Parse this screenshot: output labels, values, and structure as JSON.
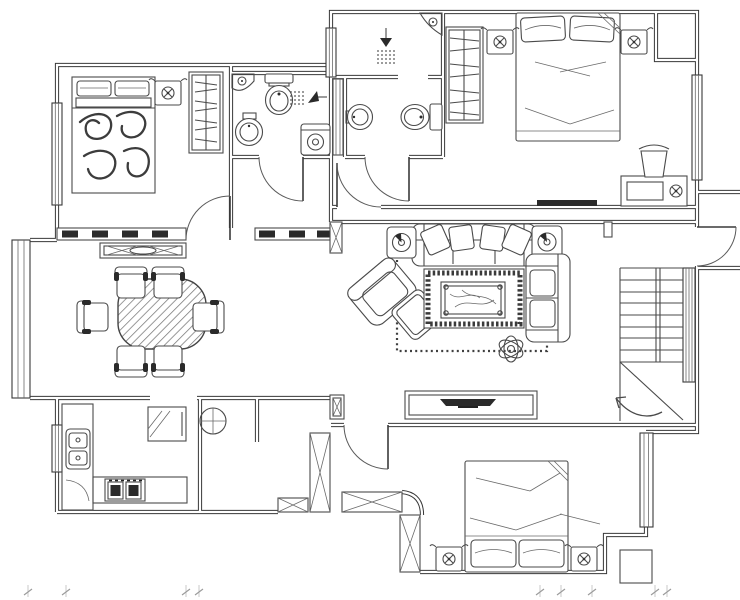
{
  "plan": {
    "type": "residential-apartment-floor-plan",
    "style": "black-and-white CAD line drawing, no text labels",
    "colors": {
      "background": "#ffffff",
      "walls": "#383838",
      "furniture": "#4a4a4a",
      "dark_fill": "#2a2a2a",
      "hatch": "#7a7a7a",
      "dimension_ticks": "#b5b5b5"
    },
    "rooms": [
      {
        "id": "bedroom-upper-left",
        "symbols": [
          "double-bed",
          "two-pillows",
          "patterned-blanket",
          "nightstand-with-lamp",
          "wardrobe-with-hangers",
          "window",
          "swing-door"
        ]
      },
      {
        "id": "bathroom-left",
        "symbols": [
          "toilet",
          "corner-shelf",
          "shower-head",
          "round-washbasin",
          "washing-machine",
          "swing-door"
        ]
      },
      {
        "id": "shower-room-center",
        "symbols": [
          "shower-head",
          "corner-washbasin",
          "window",
          "pipe-shaft"
        ]
      },
      {
        "id": "bathroom-center",
        "symbols": [
          "round-washbasin",
          "toilet",
          "swing-door"
        ]
      },
      {
        "id": "bedroom-upper-right",
        "symbols": [
          "double-bed",
          "two-pillows",
          "nightstand-with-lamp",
          "nightstand-with-lamp",
          "wardrobe-with-hangers",
          "corner-closet",
          "desk",
          "desk-chair",
          "desk-lamp",
          "wall-tv",
          "window",
          "outward-entry-door"
        ]
      },
      {
        "id": "dining-room",
        "symbols": [
          "oval-dining-table-hatched",
          "dining-chair-x6",
          "sideboard",
          "bay-window",
          "hatched-bearing-wall"
        ]
      },
      {
        "id": "living-room",
        "symbols": [
          "three-seat-sofa",
          "angled-cushions",
          "side-table-speaker",
          "side-table-speaker",
          "armchair",
          "ottoman",
          "marble-coffee-table",
          "ornate-rug",
          "chaise-sofa",
          "potted-plant",
          "tv-cabinet",
          "tv",
          "dotted-carpet-outline",
          "column"
        ]
      },
      {
        "id": "kitchen",
        "symbols": [
          "l-shaped-counter",
          "double-bowl-sink",
          "two-burner-stove",
          "refrigerator",
          "window",
          "floor-drain-circle"
        ]
      },
      {
        "id": "staircase",
        "symbols": [
          "steps",
          "handrail",
          "break-line",
          "direction-arrow",
          "glazed-partition"
        ]
      },
      {
        "id": "bedroom-lower-right",
        "symbols": [
          "double-bed",
          "two-pillows",
          "nightstand-with-lamp",
          "nightstand-with-lamp",
          "window",
          "swing-door",
          "service-column-x4",
          "vent-shaft"
        ]
      }
    ],
    "annotations": {
      "dimension_ticks": "faint tick marks along bottom edge of sheet"
    }
  }
}
